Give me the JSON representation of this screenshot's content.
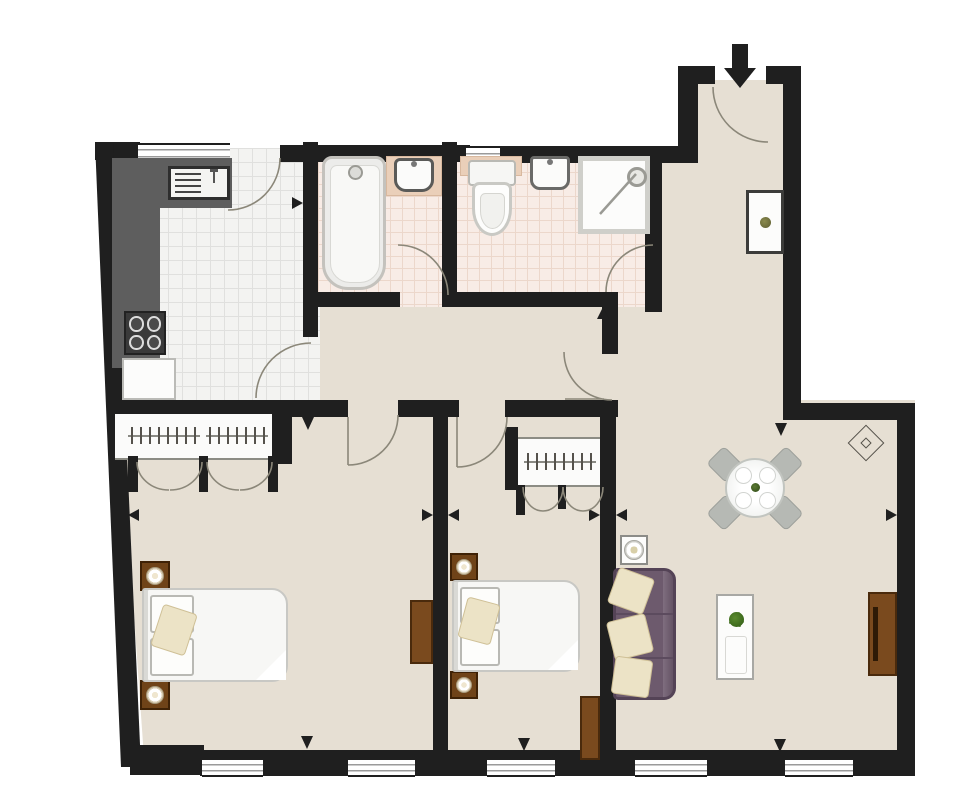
{
  "meta": {
    "type": "floor-plan",
    "description": "Two-bedroom, two-bathroom apartment floor plan with kitchen, entrance hall, inner hallway and open living/dining room",
    "canvas_width": 980,
    "canvas_height": 805,
    "window_count": 7,
    "door_count": 8,
    "bifold_wardrobe_doors": 4
  },
  "colors": {
    "wall": "#1f1f1f",
    "floor": "#e6dfd3",
    "outside": "#ffffff",
    "ktile": "#f3f3f1",
    "ktile_line": "#e0e0de",
    "btile": "#f8ece6",
    "btile_line": "#ecd7cb",
    "counter": "#5e5e5e",
    "sofa": "#6d5a6d",
    "pillow": "#ece3c6",
    "wood": "#7a4a1e",
    "wood_dark": "#4a2a0c",
    "arc": "#8b8779",
    "win_line": "#9a9a9a",
    "metal": "#9a9a94"
  },
  "rooms": [
    {
      "id": "kitchen",
      "label": "Kitchen",
      "floor": "white tile"
    },
    {
      "id": "bathroom1",
      "label": "Bathroom",
      "floor": "pink tile"
    },
    {
      "id": "bathroom2",
      "label": "Shower room",
      "floor": "pink tile"
    },
    {
      "id": "entrance",
      "label": "Entrance hall",
      "floor": "carpet"
    },
    {
      "id": "hallway",
      "label": "Inner hallway",
      "floor": "carpet"
    },
    {
      "id": "bedroom1",
      "label": "Bedroom 1",
      "floor": "carpet"
    },
    {
      "id": "bedroom2",
      "label": "Bedroom 2",
      "floor": "carpet"
    },
    {
      "id": "living",
      "label": "Living / dining room",
      "floor": "carpet"
    }
  ],
  "labels": {
    "plan": "Apartment floor plan",
    "kitchen": "Kitchen",
    "bathroom1": "Bathroom",
    "bathroom2": "Shower room",
    "entrance": "Entrance hall",
    "hallway": "Inner hallway",
    "bedroom1": "Bedroom 1",
    "bedroom2": "Bedroom 2",
    "living": "Living / dining room",
    "wall": "Wall",
    "window": "Window",
    "counter": "Kitchen counter",
    "sink": "Kitchen sink with drainer",
    "hob": "Four-ring hob",
    "cabinet": "Kitchen unit",
    "bathtub": "Bathtub",
    "vanity": "Vanity counter",
    "washbasin": "Wash basin",
    "toilet": "Toilet",
    "shower": "Shower enclosure",
    "wardrobe": "Built-in wardrobe",
    "hangers": "Hanging rail with hangers",
    "bifold": "Bi-fold wardrobe doors",
    "bed": "Double bed",
    "pillow": "Pillow",
    "nightstand": "Bedside table with lamp",
    "dresser": "Chest of drawers",
    "sofa": "Three-seat sofa",
    "cushion": "Scatter cushion",
    "coffee_table": "Coffee table with plant",
    "dining_table": "Round dining table with four chairs",
    "chair": "Dining chair",
    "plate": "Place setting",
    "side_table": "Side table with lamp",
    "console": "Console table with plant",
    "sideboard": "TV sideboard",
    "diamond": "Ceiling light symbol",
    "entry_arrow": "Main entrance arrow",
    "marker": "Surveyor marker",
    "door_arcs": "Door swing arcs",
    "plant": "Plant"
  }
}
